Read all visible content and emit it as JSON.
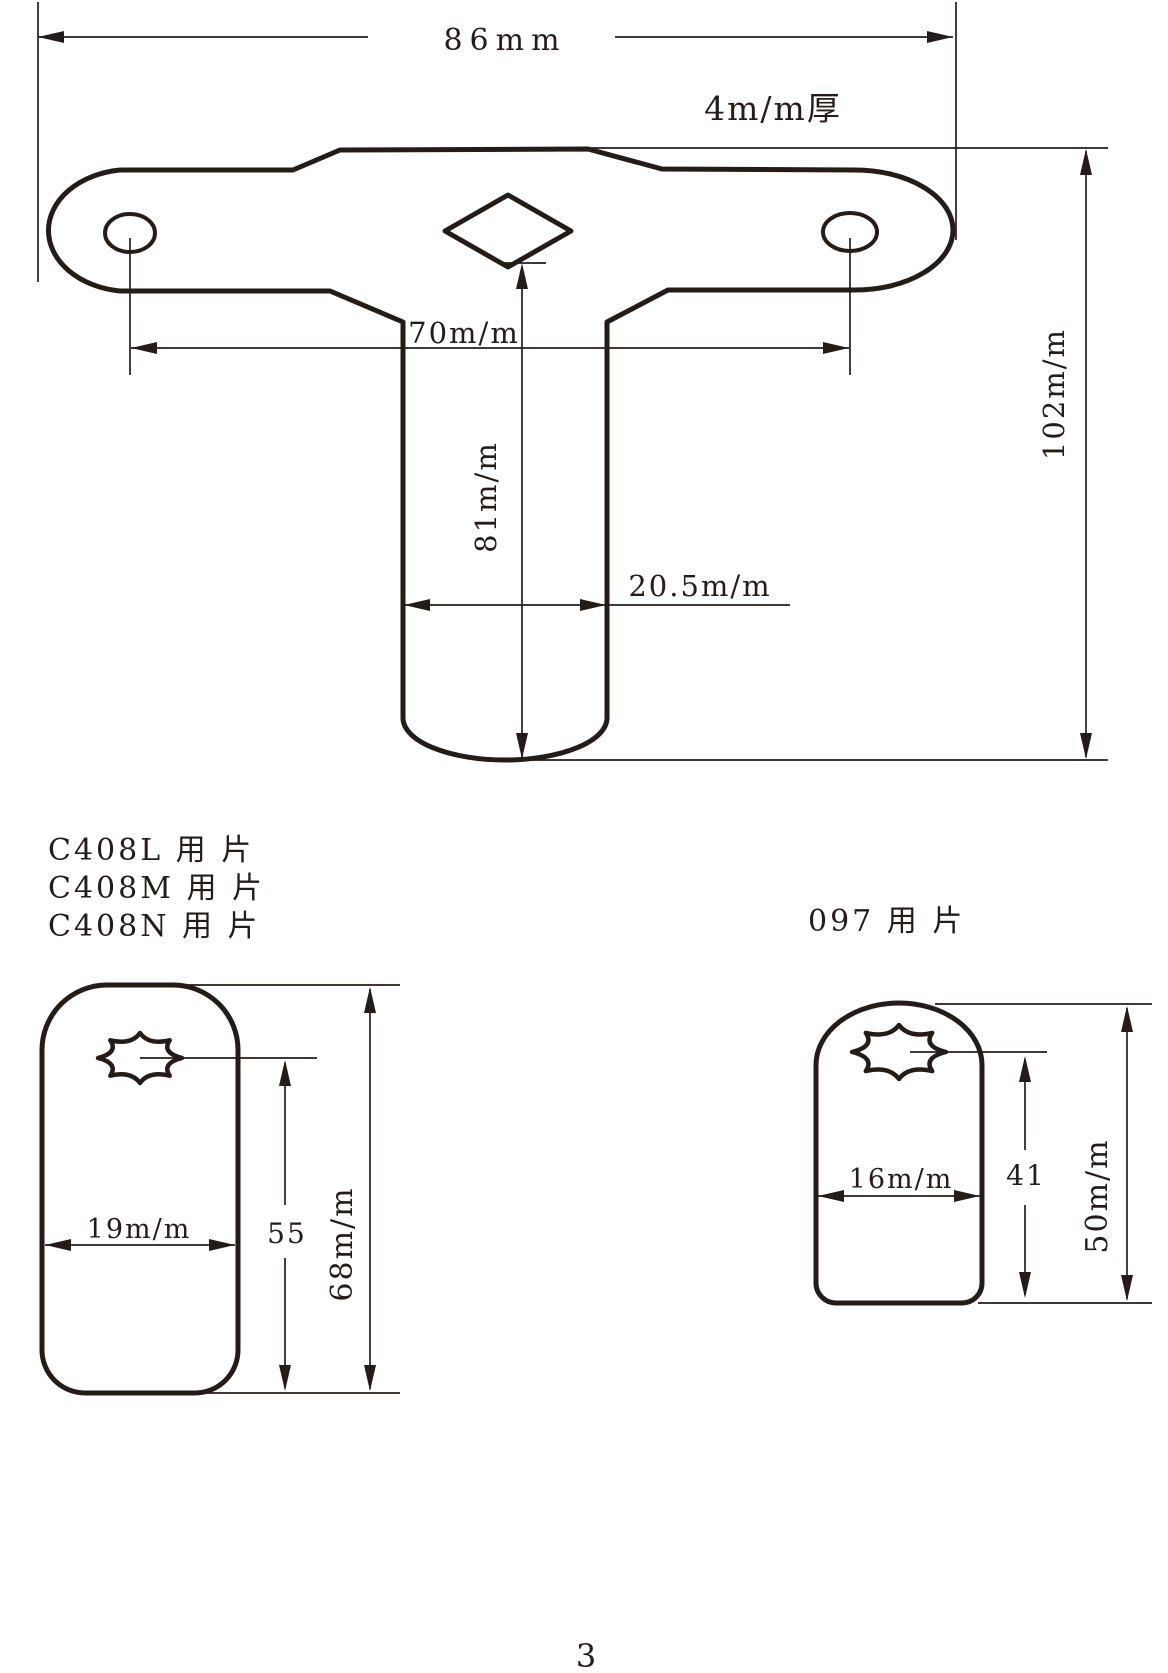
{
  "colors": {
    "ink": "#251c18",
    "paper": "#ffffff"
  },
  "page": {
    "number": "3"
  },
  "top_view": {
    "dims": {
      "overall_width": "86mm",
      "thickness": "4m/m厚",
      "hole_spacing": "70m/m",
      "stem_length": "81m/m",
      "stem_width": "20.5m/m",
      "overall_height": "102m/m"
    }
  },
  "bottom_left_view": {
    "labels": [
      "C408L 用 片",
      "C408M 用 片",
      "C408N 用 片"
    ],
    "dims": {
      "body_width": "19m/m",
      "hole_to_bottom": "55",
      "overall_height": "68m/m"
    }
  },
  "bottom_right_view": {
    "label": "097 用 片",
    "dims": {
      "body_width": "16m/m",
      "hole_to_bottom": "41",
      "overall_height": "50m/m"
    }
  }
}
